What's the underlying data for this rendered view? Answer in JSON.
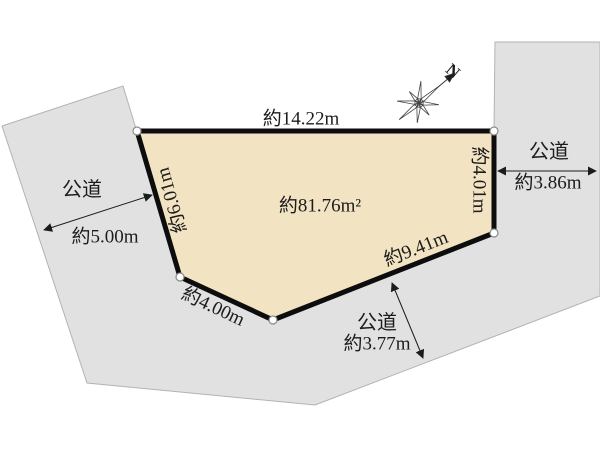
{
  "diagram": {
    "kind": "land-plot-survey-map",
    "colors": {
      "plot_fill": "#f2e3c3",
      "road_fill": "#e1e1e1",
      "plot_outline": "#0d0d0d",
      "road_outline": "#b3b3b3"
    },
    "plot": {
      "area_label": "約81.76m²",
      "edge_labels": {
        "top": "約14.22m",
        "right": "約4.01m",
        "bottom_right": "約9.41m",
        "bottom_left": "約4.00m",
        "left": "約6.01m"
      }
    },
    "roads": {
      "left": {
        "name": "公道",
        "width": "約5.00m"
      },
      "right": {
        "name": "公道",
        "width": "約3.86m"
      },
      "bottom": {
        "name": "公道",
        "width": "約3.77m"
      }
    },
    "compass": {
      "label": "N"
    }
  }
}
